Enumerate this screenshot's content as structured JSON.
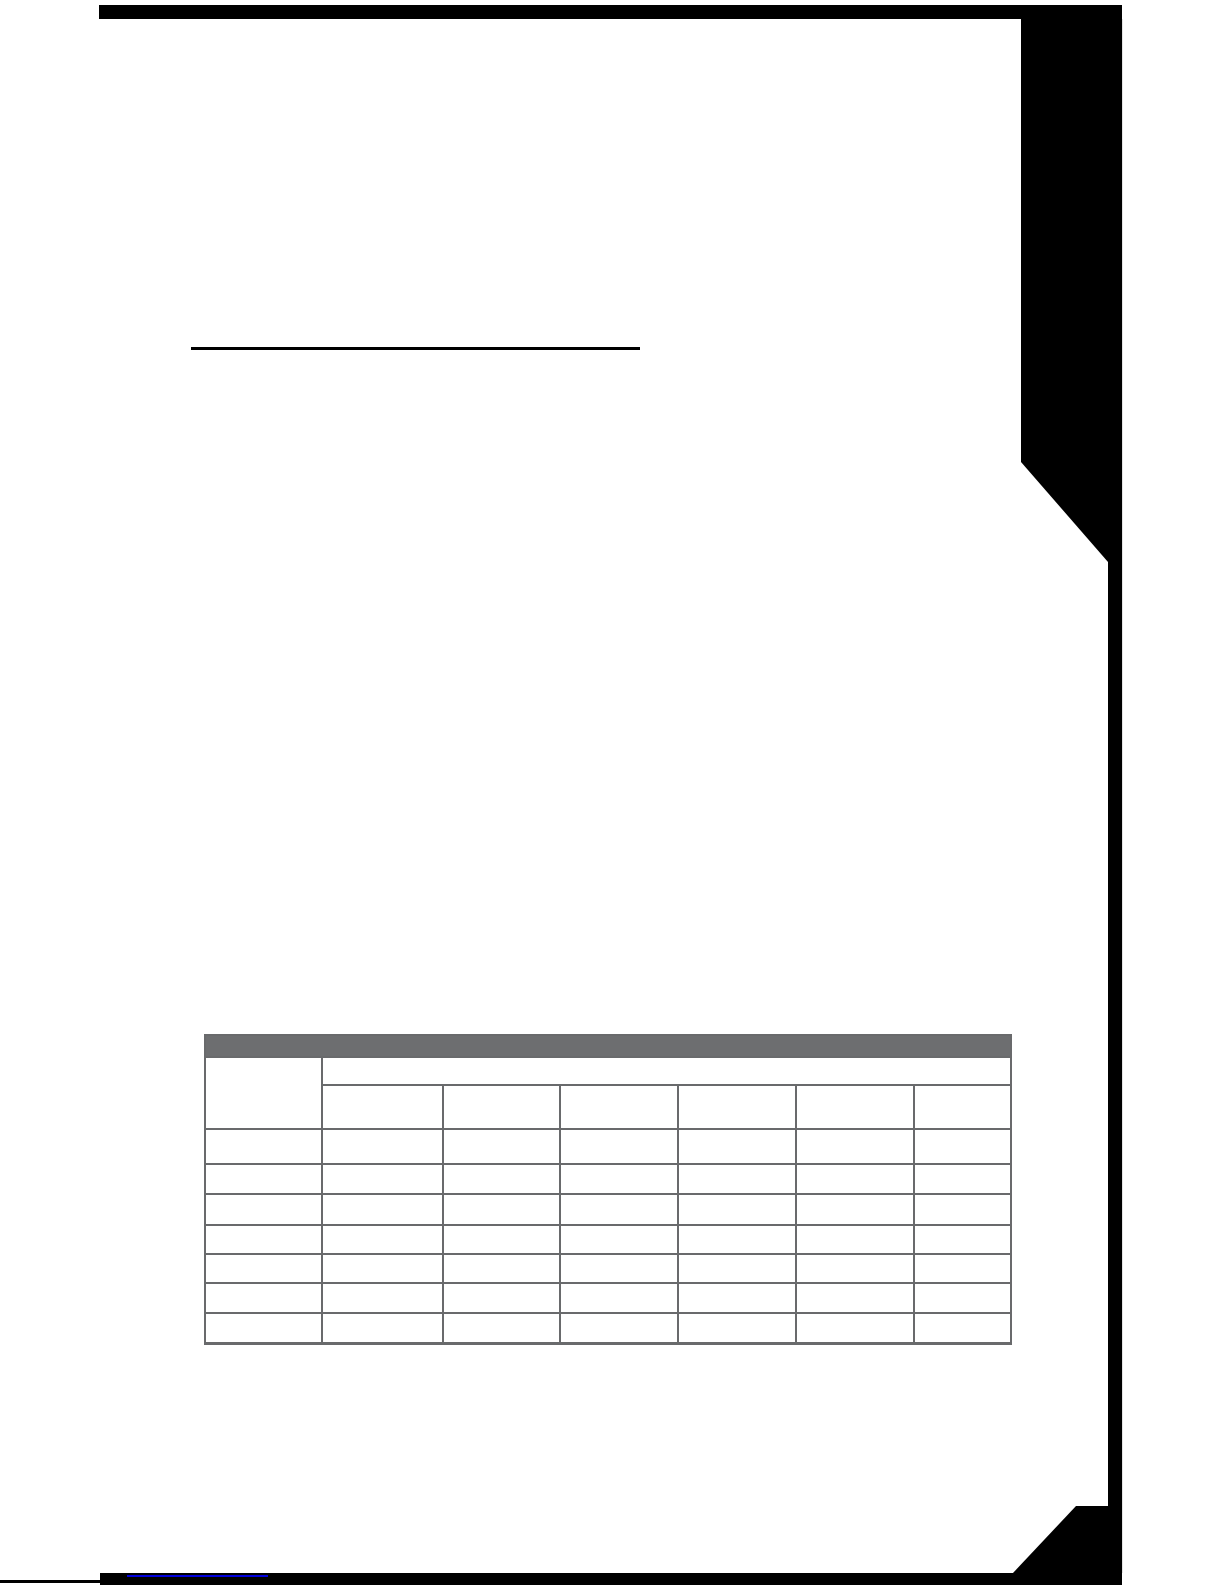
{
  "document": {
    "page_background": "#ffffff",
    "scan_edge_color": "#000000",
    "heading": {
      "text": "",
      "underline_color": "#000000"
    },
    "footer_link": {
      "text": "",
      "underline_color": "#0000dd"
    }
  },
  "table": {
    "border_color": "#696a6c",
    "header_bar_fill": "#6d6e70",
    "header_bar_text": "",
    "stub_header_text": "",
    "span_header_text": "",
    "sub_headers": [
      "",
      "",
      "",
      "",
      "",
      ""
    ],
    "rows": [
      [
        "",
        "",
        "",
        "",
        "",
        "",
        ""
      ],
      [
        "",
        "",
        "",
        "",
        "",
        "",
        ""
      ],
      [
        "",
        "",
        "",
        "",
        "",
        "",
        ""
      ],
      [
        "",
        "",
        "",
        "",
        "",
        "",
        ""
      ],
      [
        "",
        "",
        "",
        "",
        "",
        "",
        ""
      ],
      [
        "",
        "",
        "",
        "",
        "",
        "",
        ""
      ],
      [
        "",
        "",
        "",
        "",
        "",
        "",
        ""
      ]
    ]
  }
}
